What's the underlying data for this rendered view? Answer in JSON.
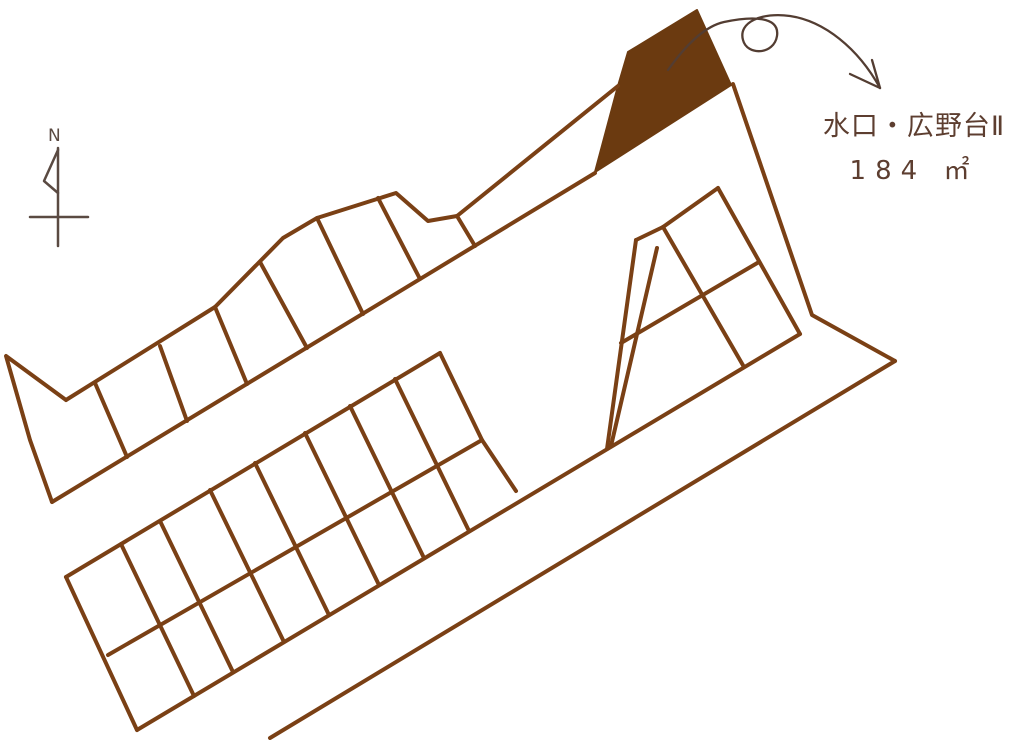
{
  "labels": {
    "parcel_name": "水口・広野台Ⅱ",
    "parcel_area": "184 ㎡",
    "north": "N"
  },
  "colors": {
    "background": "#ffffff",
    "line": "#7a4015",
    "fill": "#6b3a10",
    "text": "#5d3e30",
    "north": "#5a4a42",
    "arrow": "#533d32"
  },
  "diagram": {
    "width": 1024,
    "height": 740,
    "filled_parcel": {
      "name": "highlighted-lot",
      "points": "697,10 628,52 618,86 595,172 731,85"
    },
    "line_groups": [
      {
        "name": "upper-strip-outline",
        "stroke": "line",
        "width": 4,
        "polylines": [
          "66,400 6,356 30,440 52,502",
          "66,400 215,307 283,238 317,218 396,193 428,221 457,216",
          "52,502 595,173",
          "457,216 618,86"
        ]
      },
      {
        "name": "upper-strip-dividers",
        "stroke": "line",
        "width": 4,
        "polylines": [
          "95,383 127,457",
          "160,346 187,421",
          "215,307 247,384",
          "260,262 307,348",
          "317,218 363,314",
          "378,198 420,279",
          "457,216 475,246"
        ]
      },
      {
        "name": "right-block-outline",
        "stroke": "line",
        "width": 4,
        "polylines": [
          "733,84 812,315 895,361",
          "895,361 270,738",
          "137,730 800,334"
        ]
      },
      {
        "name": "right-block-grid",
        "stroke": "line",
        "width": 4,
        "polylines": [
          "663,227 718,188",
          "718,188 800,334",
          "744,367 663,227",
          "621,343 759,262",
          "663,227 636,240"
        ]
      },
      {
        "name": "triangle-lot",
        "stroke": "line",
        "width": 4,
        "polylines": [
          "636,240 607,449",
          "657,248 611,446"
        ]
      },
      {
        "name": "lower-strip-outline",
        "stroke": "line",
        "width": 4,
        "polylines": [
          "66,577 137,730",
          "66,577 440,353",
          "108,655 482,440",
          "440,353 482,440 516,491"
        ]
      },
      {
        "name": "lower-strip-dividers",
        "stroke": "line",
        "width": 4,
        "polylines": [
          "121,544 194,696",
          "160,521 233,672",
          "210,490 284,642",
          "255,463 329,615",
          "305,433 379,585",
          "350,406 424,558",
          "395,379 469,531"
        ]
      }
    ],
    "annotation_arrow": {
      "name": "curly-arrow",
      "width": 2.3,
      "curve": "M 668,70 C 688,42 706,26 724,22 C 752,16 780,16 777,36 C 774,55 747,56 743,40 C 738,22 762,12 790,16 C 824,21 858,48 880,88",
      "head": [
        "880,88 872,60",
        "880,88 850,74"
      ]
    },
    "north_symbol": {
      "name": "north-indicator",
      "width": 2.5,
      "polylines": [
        "58,148 58,246",
        "58,150 44,181 58,193",
        "30,217 88,217"
      ]
    }
  }
}
